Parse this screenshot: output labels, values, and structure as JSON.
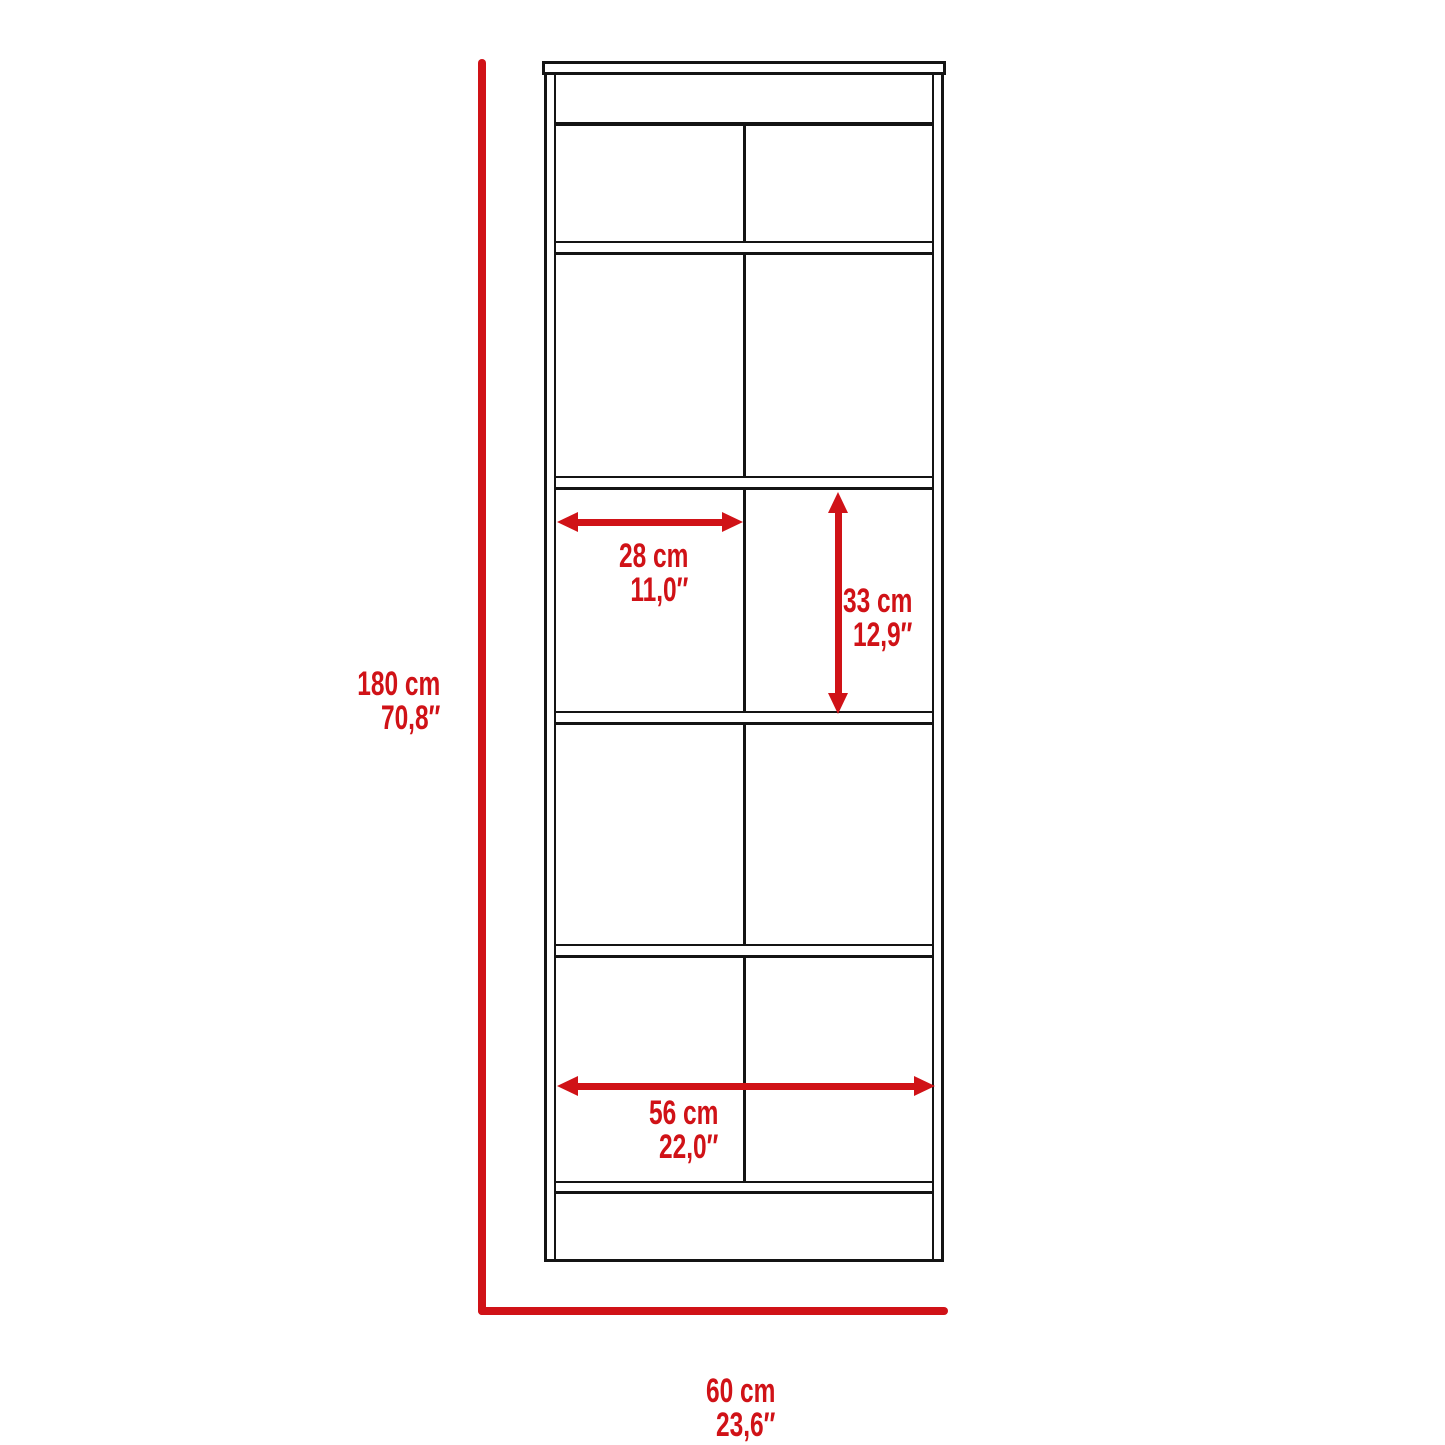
{
  "diagram": {
    "type": "furniture-dimension-diagram",
    "subject": "bookcase front elevation with five two-column shelf rows",
    "background": "#ffffff",
    "colors": {
      "outline": "#141414",
      "dimension_red": "#d01217"
    },
    "structure": {
      "shelf_rows": 5,
      "columns_per_row": 2,
      "has_top_cap": true,
      "has_top_band": true,
      "has_bottom_kick_band": true
    },
    "dimensions": {
      "overall_height": {
        "cm": "180 cm",
        "inch": "70,8″"
      },
      "overall_width": {
        "cm": "60 cm",
        "inch": "23,6″"
      },
      "compartment_width": {
        "cm": "28 cm",
        "inch": "11,0″"
      },
      "compartment_height": {
        "cm": "33 cm",
        "inch": "12,9″"
      },
      "interior_width": {
        "cm": "56 cm",
        "inch": "22,0″"
      }
    }
  }
}
